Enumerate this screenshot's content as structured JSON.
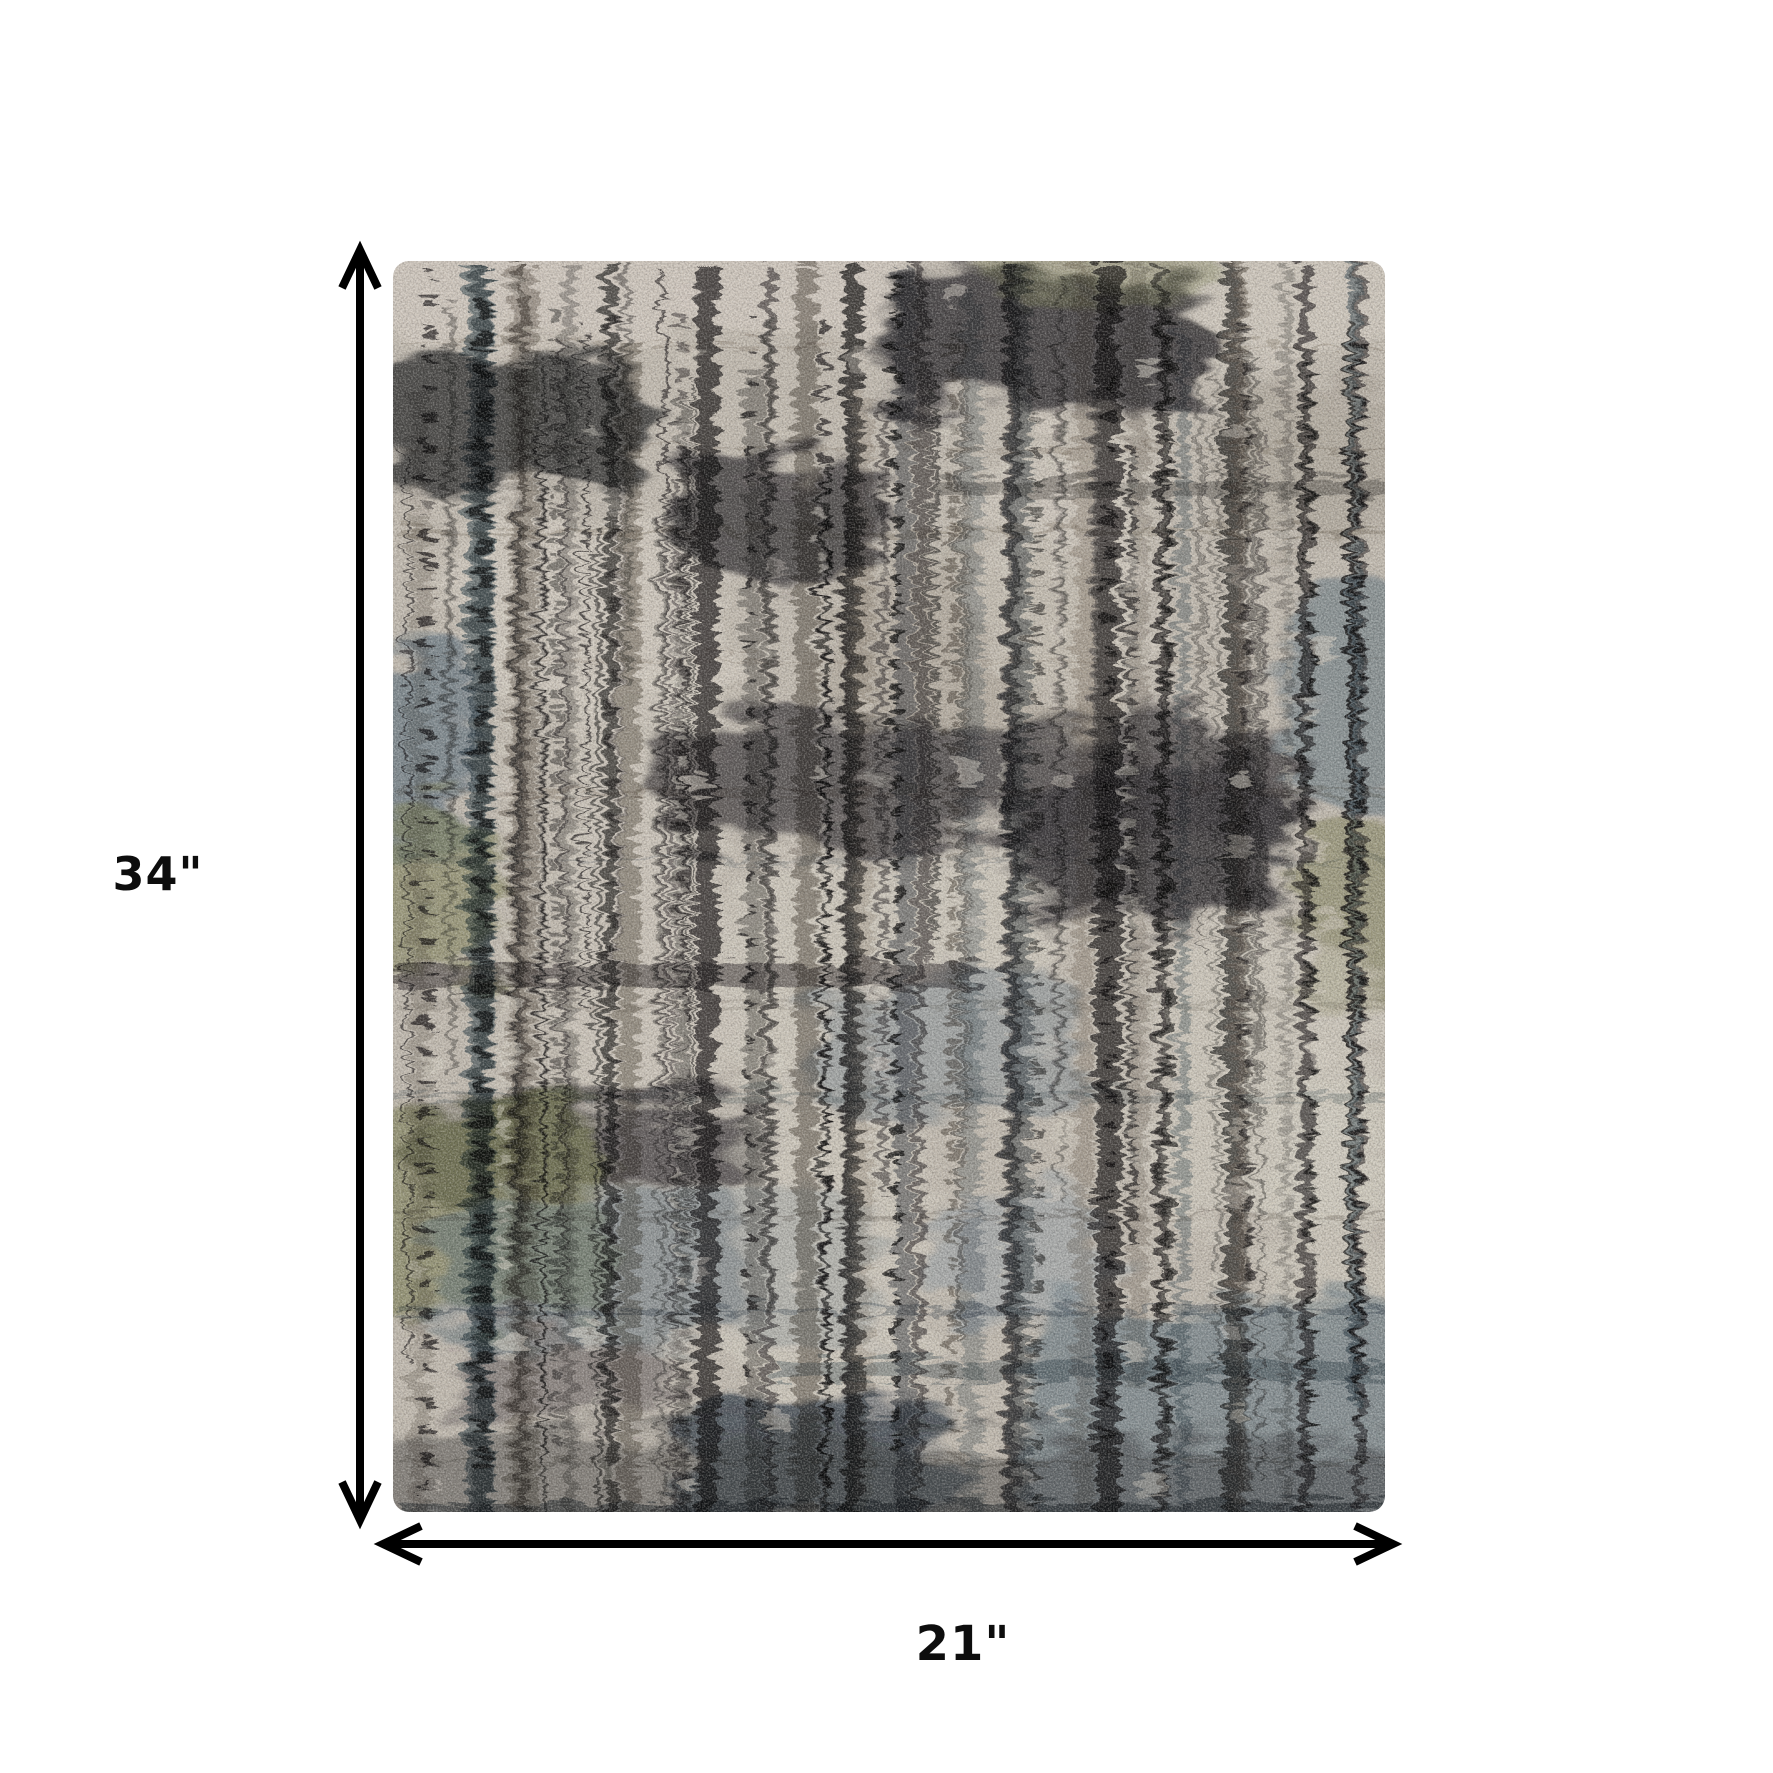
{
  "page": {
    "background_color": "#ffffff"
  },
  "dimensions": {
    "height_label": "34\"",
    "height_value": 34,
    "width_label": "21\"",
    "width_value": 21
  },
  "annotation": {
    "arrow_color": "#000000",
    "label_color": "#0d0d0d"
  },
  "rug": {
    "description": "Top-down photo of a distressed abstract area rug with vertical striations, dotted columns and plaid-like dark bands",
    "base": "#c3bcb1",
    "palette": {
      "cream": "#d8d1c6",
      "taupe": "#a89f93",
      "gray": "#7e7870",
      "charcoal": "#3b393b",
      "slate_blue": "#566b7a",
      "steel_blue": "#7d93a2",
      "olive": "#7c7d52",
      "dark_navy": "#333e49"
    }
  }
}
